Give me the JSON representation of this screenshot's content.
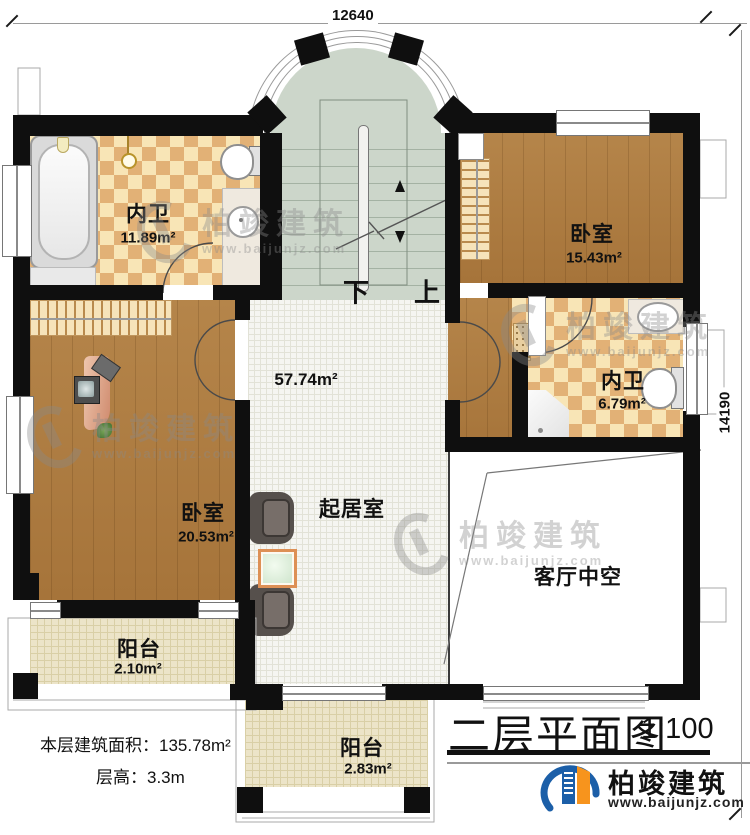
{
  "dimensions": {
    "top": "12640",
    "right": "14190"
  },
  "stair": {
    "down": "下",
    "up": "上"
  },
  "rooms": {
    "bath_top": {
      "name": "内卫",
      "area": "11.89m²"
    },
    "bedroom_right": {
      "name": "卧室",
      "area": "15.43m²"
    },
    "bath_right": {
      "name": "内卫",
      "area": "6.79m²"
    },
    "bedroom_left": {
      "name": "卧室",
      "area": "20.53m²"
    },
    "living": {
      "name": "起居室",
      "area": "57.74m²"
    },
    "void": {
      "name": "客厅中空"
    },
    "balcony_left": {
      "name": "阳台",
      "area": "2.10m²"
    },
    "balcony_bottom": {
      "name": "阳台",
      "area": "2.83m²"
    }
  },
  "notes": {
    "floor_area_label": "本层建筑面积：",
    "floor_area_value": "135.78m²",
    "floor_height_label": "层高：",
    "floor_height_value": "3.3m"
  },
  "title": {
    "text": "二层平面图",
    "scale": "1:100"
  },
  "brand": {
    "name": "柏竣建筑",
    "url": "www.baijunjz.com"
  },
  "watermark": {
    "name": "柏竣建筑",
    "url": "www.baijunjz.com"
  },
  "colors": {
    "wall": "#0f0f0f",
    "wood": "#ab7b3e",
    "tile_light": "#f8e5b6",
    "tile_dark": "#e2b176",
    "stair": "#ccd6ca",
    "bed": "#74bfdb",
    "balcony": "#ece4c8",
    "logo_blue": "#1c5fa8",
    "logo_orange": "#f7941d"
  }
}
